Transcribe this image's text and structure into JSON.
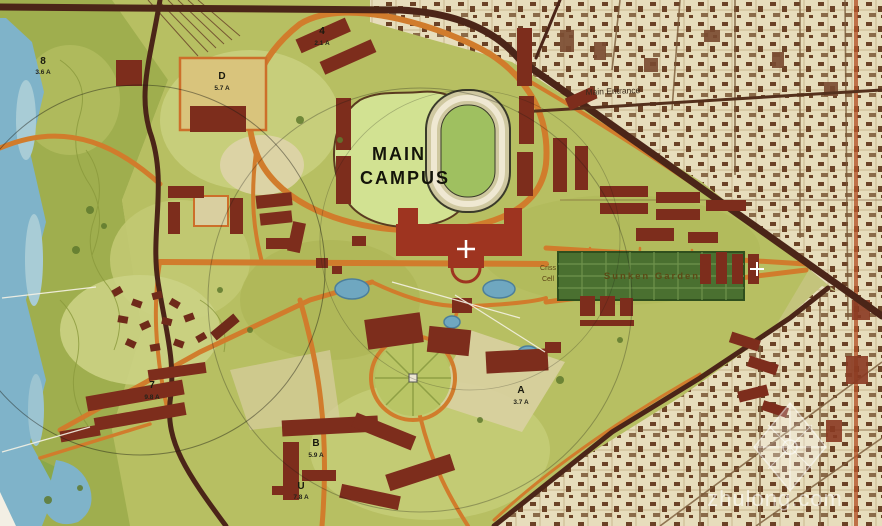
{
  "map": {
    "title": {
      "line1": "MAIN",
      "line2": "CAMPUS"
    },
    "labels": {
      "main_entrance": "Main Entrance",
      "sunken_garden": "Sunken Garden",
      "criss_line1": "Criss",
      "criss_line2": "Cell"
    },
    "zones": [
      {
        "label": "8",
        "area": "3.6 A"
      },
      {
        "label": "D",
        "area": "5.7 A"
      },
      {
        "label": "4",
        "area": "2.1 A"
      },
      {
        "label": "7",
        "area": "9.8 A"
      },
      {
        "label": "A",
        "area": "3.7 A"
      },
      {
        "label": "B",
        "area": "5.9 A"
      },
      {
        "label": "U",
        "area": "7.8 A"
      }
    ],
    "watermark": "zhulong.com",
    "colors": {
      "water": "#7fb3c9",
      "terrain_green": "#9fae4e",
      "campus_green": "#b7bf62",
      "lawn_green": "#d2e292",
      "road_orange": "#d17c2c",
      "road_dark": "#4b2518",
      "building_maroon": "#7d2d1c",
      "building_bright": "#9e3420",
      "urban_beige": "#e7ddbc",
      "sunken_garden_green": "#4a7030"
    }
  }
}
